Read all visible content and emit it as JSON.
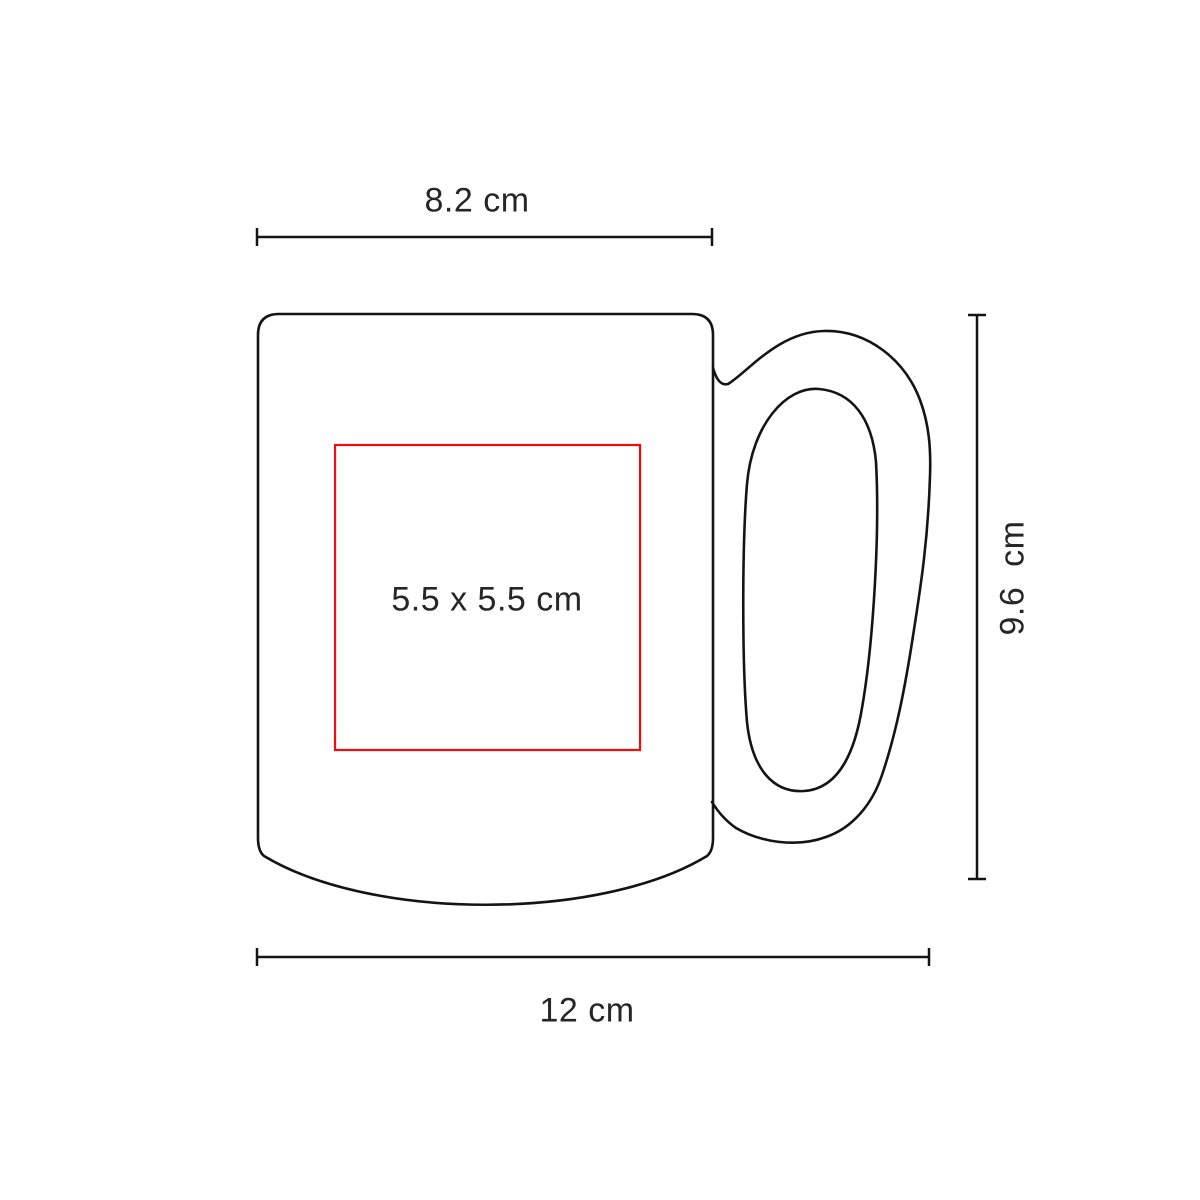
{
  "page": {
    "background_color": "#ffffff"
  },
  "colors": {
    "outline": "#141414",
    "print_area_border": "#f40b0b",
    "label_text": "#262626"
  },
  "diagram": {
    "kind": "mug-print-area-dimension-drawing",
    "product": "ceramic mug with ring handle",
    "dimensions": {
      "top_width": {
        "label": "8.2 cm",
        "value_cm": 8.2
      },
      "right_height": {
        "label": "9.6 cm",
        "value_cm": 9.6
      },
      "bottom_width": {
        "label": "12 cm",
        "value_cm": 12
      },
      "print_area": {
        "label": "5.5 x 5.5 cm",
        "width_cm": 5.5,
        "height_cm": 5.5
      }
    }
  }
}
